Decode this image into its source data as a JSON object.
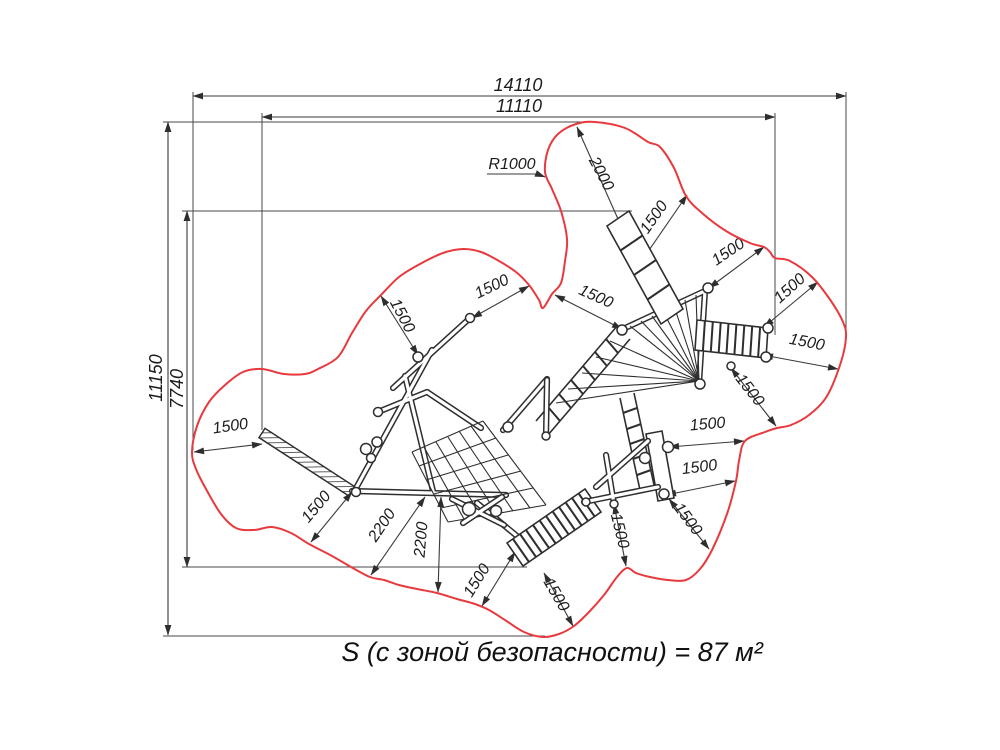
{
  "colors": {
    "line": "#2e2e2e",
    "dimension": "#3a3a3a",
    "safety_zone_outline": "#e8393e",
    "background": "#ffffff"
  },
  "dimensions": {
    "overall_width": "14110",
    "equipment_width": "11110",
    "overall_height": "11150",
    "equipment_height": "7740",
    "corner_radius": "R1000",
    "slide_runout": "2000"
  },
  "clearance_1500_labels": [
    "1500",
    "1500",
    "1500",
    "1500",
    "1500",
    "1500",
    "1500",
    "1500",
    "1500",
    "1500",
    "1500",
    "1500",
    "1500",
    "1500",
    "1500",
    "1500"
  ],
  "clearance_2200_labels": [
    "2200",
    "2200"
  ],
  "caption": {
    "text": "S (с зоной безопасности) = 87 м²"
  }
}
